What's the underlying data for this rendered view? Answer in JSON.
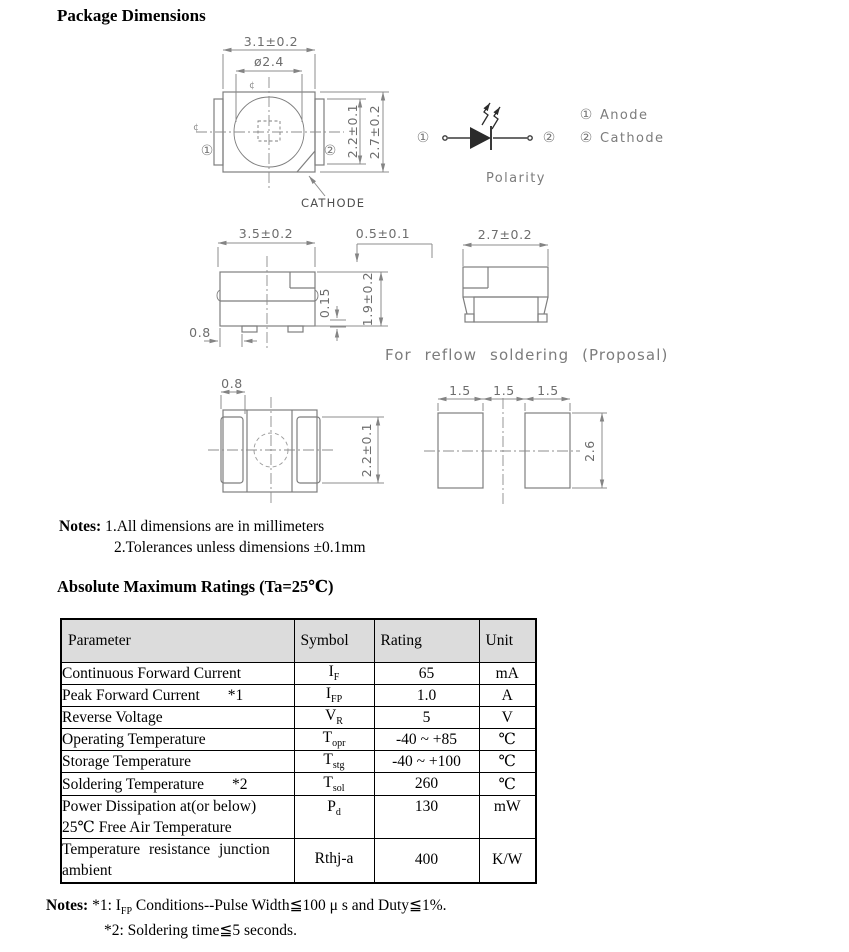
{
  "page": {
    "title": "Package Dimensions"
  },
  "drawings": {
    "top_view": {
      "dim_body_width": "3.1±0.2",
      "dim_lens_dia": "ø2.4",
      "dim_electrode_height": "2.2±0.1",
      "dim_body_height": "2.7±0.2",
      "pin1_mark": "①",
      "pin2_mark": "②",
      "centerline_mark": "¢",
      "cathode_label": "CATHODE"
    },
    "polarity": {
      "pin1_mark": "①",
      "pin2_mark": "②",
      "legend": [
        {
          "mark": "①",
          "label": "Anode"
        },
        {
          "mark": "②",
          "label": "Cathode"
        }
      ],
      "caption": "Polarity"
    },
    "front_view": {
      "dim_body_width": "3.5±0.2",
      "dim_step_height": "0.5±0.1",
      "dim_standoff": "0.15",
      "dim_body_height": "1.9±0.2",
      "dim_lead_inset": "0.8"
    },
    "side_view": {
      "dim_body_depth": "2.7±0.2"
    },
    "reflow_caption": "For reflow soldering (Proposal)",
    "bottom_view": {
      "dim_lead_width": "0.8",
      "dim_electrode_height": "2.2±0.1"
    },
    "pad_layout": {
      "dim_pad_left": "1.5",
      "dim_pad_gap": "1.5",
      "dim_pad_right": "1.5",
      "dim_pad_height": "2.6"
    }
  },
  "dimension_notes": {
    "label": "Notes:",
    "line1": "1.All dimensions are in millimeters",
    "line2": "2.Tolerances unless dimensions ±0.1mm"
  },
  "ratings": {
    "heading": "Absolute Maximum Ratings (Ta=25℃)",
    "columns": [
      "Parameter",
      "Symbol",
      "Rating",
      "Unit"
    ],
    "rows": [
      {
        "parameter": "Continuous Forward Current",
        "footnote": "",
        "symbol_base": "I",
        "symbol_sub": "F",
        "rating": "65",
        "unit": "mA"
      },
      {
        "parameter": "Peak Forward Current",
        "footnote": "*1",
        "symbol_base": "I",
        "symbol_sub": "FP",
        "rating": "1.0",
        "unit": "A"
      },
      {
        "parameter": "Reverse Voltage",
        "footnote": "",
        "symbol_base": "V",
        "symbol_sub": "R",
        "rating": "5",
        "unit": "V"
      },
      {
        "parameter": "Operating Temperature",
        "footnote": "",
        "symbol_base": "T",
        "symbol_sub": "opr",
        "rating": "-40 ~ +85",
        "unit": "℃"
      },
      {
        "parameter": "Storage Temperature",
        "footnote": "",
        "symbol_base": "T",
        "symbol_sub": "stg",
        "rating": "-40 ~ +100",
        "unit": "℃"
      },
      {
        "parameter": "Soldering Temperature",
        "footnote": "*2",
        "symbol_base": "T",
        "symbol_sub": "sol",
        "rating": "260",
        "unit": "℃"
      },
      {
        "parameter": "Power Dissipation at(or below)",
        "parameter_line2": "25℃ Free Air Temperature",
        "footnote": "",
        "symbol_base": "P",
        "symbol_sub": "d",
        "rating": "130",
        "unit": "mW"
      },
      {
        "parameter": "Temperature resistance junction",
        "parameter_line2": "ambient",
        "footnote": "",
        "symbol_base": "Rthj-a",
        "symbol_sub": "",
        "rating": "400",
        "unit": "K/W"
      }
    ]
  },
  "footnotes": {
    "label": "Notes:",
    "note1_pre": "*1: I",
    "note1_sub": "FP",
    "note1_post": " Conditions--Pulse Width≦100 μ s and Duty≦1%.",
    "note2": "*2: Soldering time≦5 seconds."
  }
}
